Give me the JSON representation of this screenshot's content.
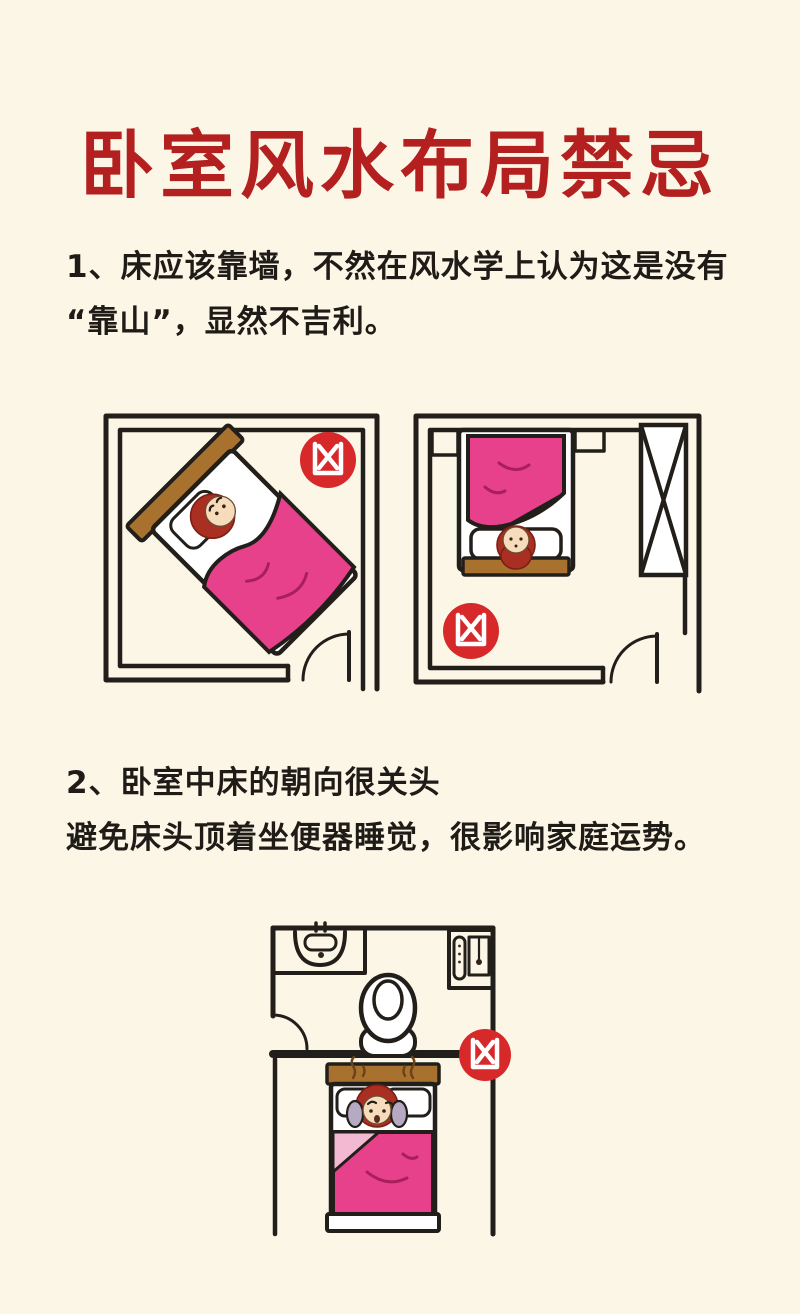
{
  "poster": {
    "title": "卧室风水布局禁忌"
  },
  "rules": [
    {
      "number": "1",
      "lines": [
        "1、床应该靠墙，不然在风水学上认为这是没有",
        "“靠山”，显然不吉利。"
      ]
    },
    {
      "number": "2",
      "lines": [
        "2、卧室中床的朝向很关头",
        "避免床头顶着坐便器睡觉，很影响家庭运势。"
      ]
    }
  ],
  "bad_luck_badge": {
    "glyph": "凶"
  },
  "colors": {
    "background": "#fcf6e7",
    "title_red": "#b3201f",
    "text_black": "#1f1c18",
    "line": "#221f1b",
    "pink": "#e8418c",
    "pink_light": "#f3b9d3",
    "pink_deep": "#a81f5c",
    "brown": "#a9712e",
    "hair": "#a92f22",
    "skin": "#f6dcba",
    "sleeve": "#b5a9c3",
    "badge_red": "#d7282a"
  }
}
